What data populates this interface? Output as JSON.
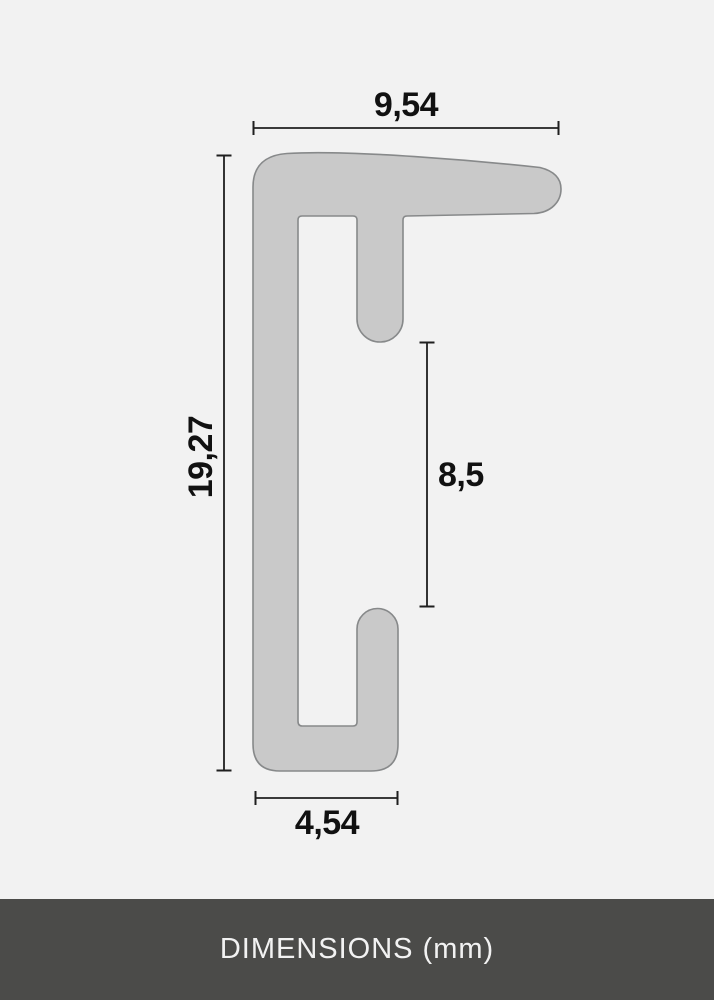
{
  "diagram": {
    "type": "technical-cross-section",
    "unit_label": "DIMENSIONS (mm)",
    "dimensions": [
      {
        "id": "top-width",
        "value": "9,54",
        "orientation": "horizontal"
      },
      {
        "id": "overall-height",
        "value": "19,27",
        "orientation": "vertical"
      },
      {
        "id": "rabbet-height",
        "value": "8,5",
        "orientation": "vertical"
      },
      {
        "id": "bottom-width",
        "value": "4,54",
        "orientation": "horizontal"
      }
    ],
    "colors": {
      "background": "#f2f2f2",
      "profile_fill": "#c9c9c9",
      "profile_stroke": "#87898a",
      "dimension_line": "#1f1f1f",
      "label_text": "#111111",
      "footer_background": "#4b4b49",
      "footer_text": "#f2f2f2"
    }
  }
}
